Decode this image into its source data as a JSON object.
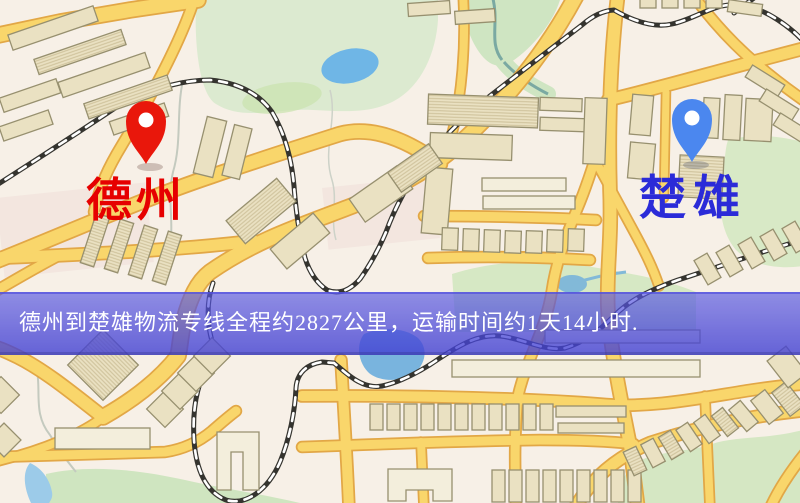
{
  "map": {
    "origin_pin": {
      "label": "德州",
      "pin_color": "#e9170b",
      "label_color": "#e60000"
    },
    "destination_pin": {
      "label": "楚雄",
      "pin_color": "#4b87ef",
      "label_color": "#2b2bd8"
    },
    "banner": {
      "text": "德州到楚雄物流专线全程约2827公里，运输时间约1天14小时.",
      "text_color": "#ffffff",
      "bg_color": "#5553d8"
    },
    "colors": {
      "background": "#f7f0e7",
      "road_fill": "#f9d66b",
      "road_casing": "#e2a746",
      "park_green": "#dcead0",
      "water_blue": "#6fb6e6",
      "building_fill": "#eae1c2",
      "railway": "#35342f"
    }
  }
}
